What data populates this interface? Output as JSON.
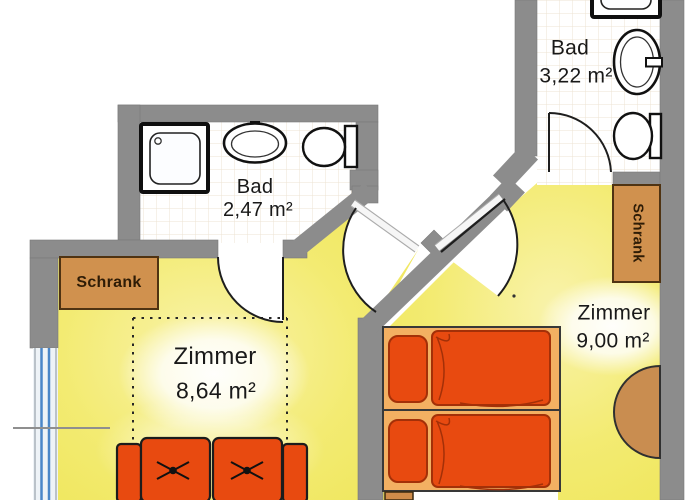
{
  "title": "Apartment floor plan",
  "rooms": {
    "bath_left": {
      "label": "Bad",
      "area": "2,47 m²"
    },
    "bath_right": {
      "label": "Bad",
      "area": "3,22 m²"
    },
    "room_left": {
      "label": "Zimmer",
      "area": "8,64 m²"
    },
    "room_right": {
      "label": "Zimmer",
      "area": "9,00 m²"
    },
    "closet_left": {
      "label": "Schrank"
    },
    "closet_right": {
      "label": "Schrank"
    }
  },
  "colors": {
    "wall": "#8c8c8c",
    "floor_yellow": "#f1e95f",
    "furniture_orange": "#e84a10",
    "bed_frame": "#f3b062",
    "wood": "#d0914e",
    "window_blue": "#4a86c8",
    "tile_line": "#ece3d3"
  }
}
